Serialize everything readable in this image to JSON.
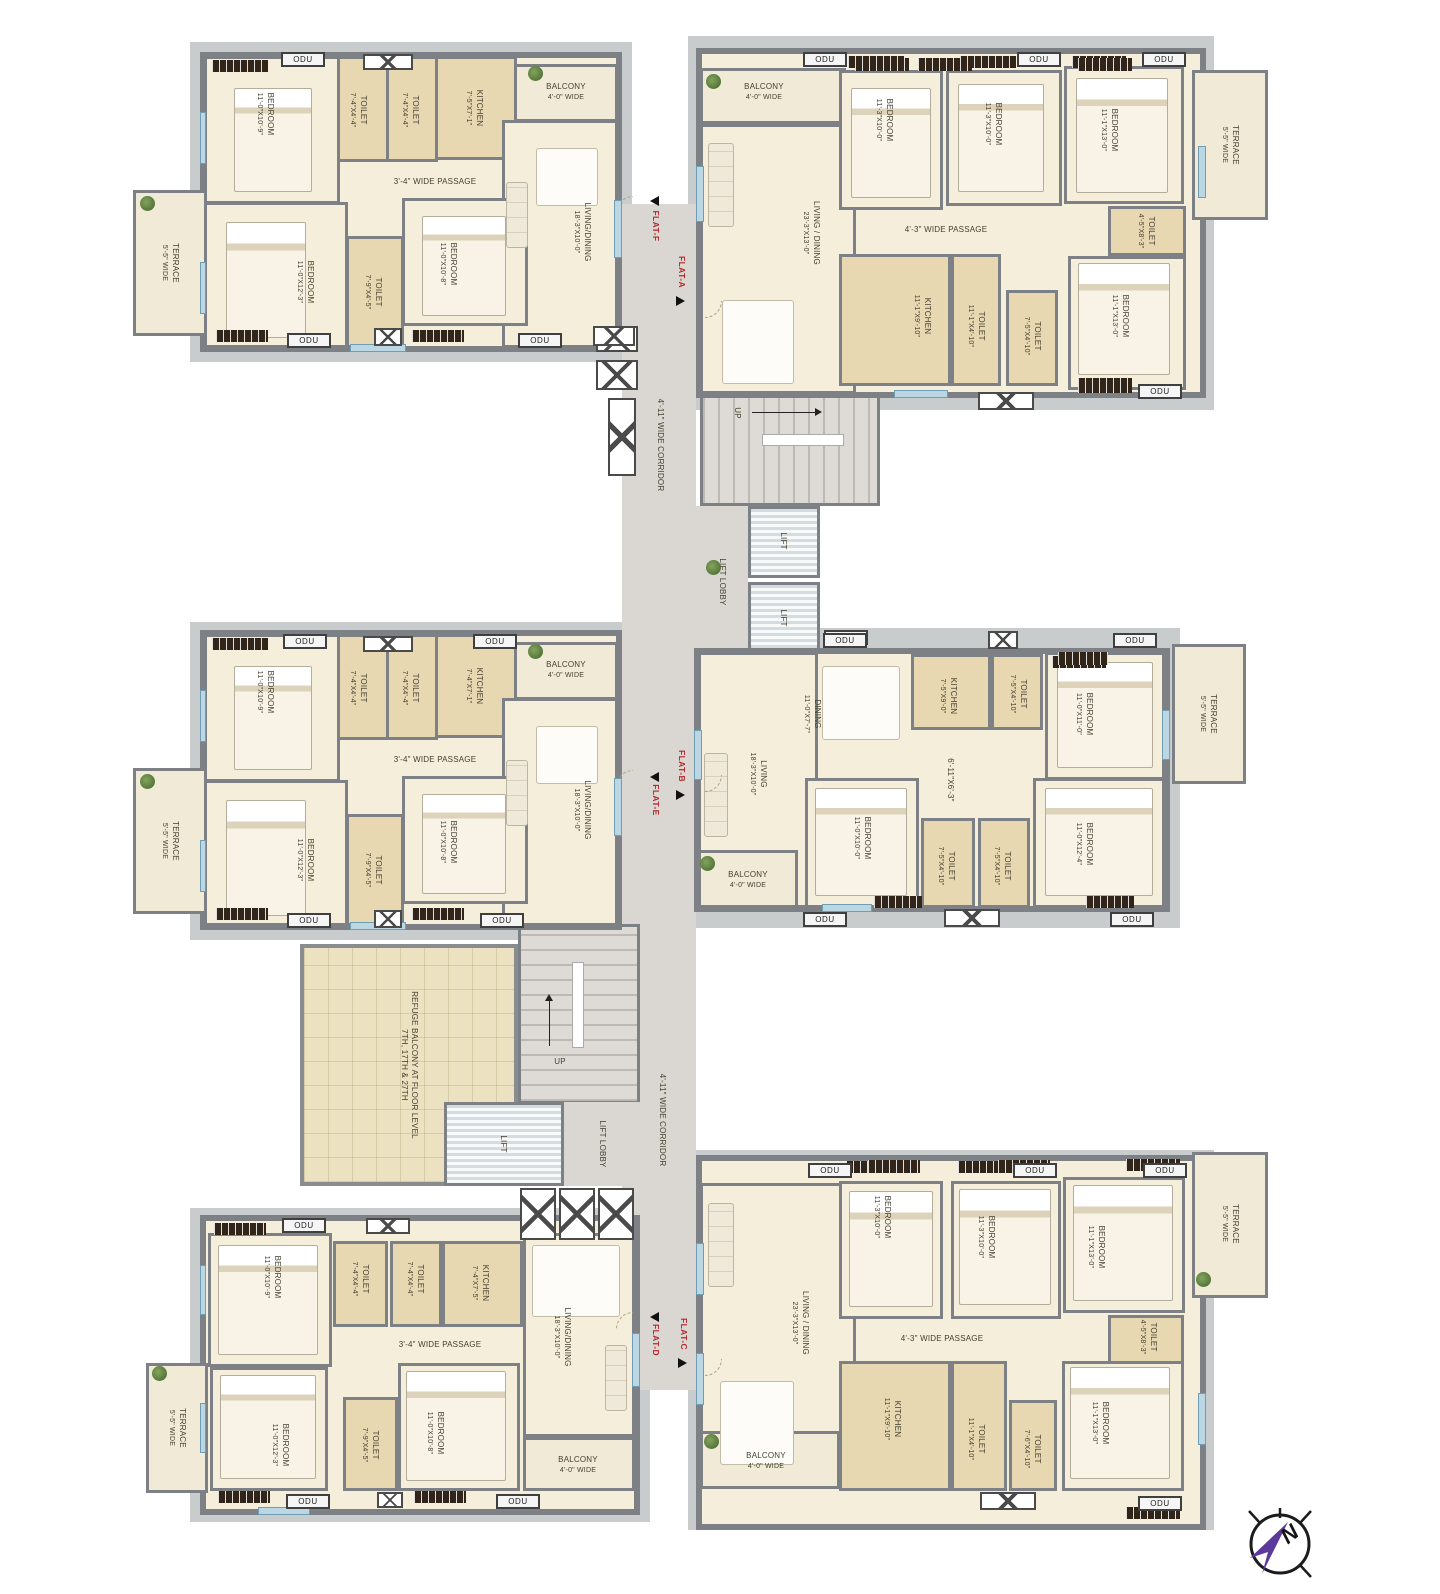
{
  "labels": {
    "odu": "ODU"
  },
  "compass": {
    "n": "N"
  },
  "core_top": {
    "corridor": "4'-11\" WIDE CORRIDOR",
    "lift_lobby": "LIFT LOBBY",
    "lift_a": "LIFT",
    "lift_b": "LIFT",
    "up": "UP"
  },
  "core_bottom": {
    "corridor": "4'-11\" WIDE CORRIDOR",
    "lift_lobby": "LIFT LOBBY",
    "lift": "LIFT",
    "up": "UP",
    "refuge_line1": "REFUGE BALCONY AT FLOOR LEVEL",
    "refuge_line2": "7TH, 17TH & 27TH"
  },
  "flats": {
    "flat_f": {
      "tag": "FLAT-F",
      "rooms": {
        "bedroom1": {
          "name": "BEDROOM",
          "dim": "11'-0\"X10'-9\""
        },
        "toilet1": {
          "name": "TOILET",
          "dim": "7'-4\"X4'-4\""
        },
        "toilet2": {
          "name": "TOILET",
          "dim": "7'-4\"X4'-4\""
        },
        "kitchen": {
          "name": "KITCHEN",
          "dim": "7'-5\"X7'-1\""
        },
        "balcony": {
          "name": "BALCONY",
          "dim": "4'-0\" WIDE"
        },
        "passage": {
          "name": "3'-4\" WIDE PASSAGE"
        },
        "bedroom2": {
          "name": "BEDROOM",
          "dim": "11'-0\"X12'-3\""
        },
        "toilet3": {
          "name": "TOILET",
          "dim": "7'-9\"X4'-5\""
        },
        "bedroom3": {
          "name": "BEDROOM",
          "dim": "11'-0\"X10'-8\""
        },
        "living": {
          "name": "LIVING/DINING",
          "dim": "18'-3\"X10'-0\""
        },
        "terrace": {
          "name": "TERRACE",
          "dim": "5'-5\" WIDE"
        }
      }
    },
    "flat_a": {
      "tag": "FLAT-A",
      "rooms": {
        "balcony": {
          "name": "BALCONY",
          "dim": "4'-0\" WIDE"
        },
        "living": {
          "name": "LIVING / DINING",
          "dim": "23'-3\"X13'-0\""
        },
        "bedroom1": {
          "name": "BEDROOM",
          "dim": "11'-3\"X10'-0\""
        },
        "bedroom2": {
          "name": "BEDROOM",
          "dim": "11'-3\"X10'-0\""
        },
        "bedroom3": {
          "name": "BEDROOM",
          "dim": "11'-1\"X13'-0\""
        },
        "toilet1": {
          "name": "TOILET",
          "dim": "4'-5\"X8'-3\""
        },
        "bedroom4": {
          "name": "BEDROOM",
          "dim": "11'-1\"X13'-0\""
        },
        "passage": {
          "name": "4'-3\" WIDE PASSAGE"
        },
        "kitchen": {
          "name": "KITCHEN",
          "dim": "11'-1\"X9'-10\""
        },
        "toilet2": {
          "name": "TOILET",
          "dim": "11'-1\"X4'-10\""
        },
        "toilet3": {
          "name": "TOILET",
          "dim": "7'-5\"X4'-10\""
        },
        "terrace": {
          "name": "TERRACE",
          "dim": "5'-5\" WIDE"
        }
      }
    },
    "flat_e": {
      "tag": "FLAT-E",
      "rooms": {
        "bedroom1": {
          "name": "BEDROOM",
          "dim": "11'-0\"X10'-9\""
        },
        "toilet1": {
          "name": "TOILET",
          "dim": "7'-4\"X4'-4\""
        },
        "toilet2": {
          "name": "TOILET",
          "dim": "7'-4\"X4'-4\""
        },
        "kitchen": {
          "name": "KITCHEN",
          "dim": "7'-4\"X7'-1\""
        },
        "balcony": {
          "name": "BALCONY",
          "dim": "4'-0\" WIDE"
        },
        "passage": {
          "name": "3'-4\" WIDE PASSAGE"
        },
        "bedroom2": {
          "name": "BEDROOM",
          "dim": "11'-0\"X12'-3\""
        },
        "toilet3": {
          "name": "TOILET",
          "dim": "7'-9\"X4'-5\""
        },
        "bedroom3": {
          "name": "BEDROOM",
          "dim": "11'-0\"X10'-8\""
        },
        "living": {
          "name": "LIVING/DINING",
          "dim": "18'-3\"X10'-0\""
        },
        "terrace": {
          "name": "TERRACE",
          "dim": "5'-5\" WIDE"
        }
      }
    },
    "flat_b": {
      "tag": "FLAT-B",
      "rooms": {
        "living": {
          "name": "LIVING",
          "dim": "18'-3\"X10'-0\""
        },
        "dining": {
          "name": "DINING",
          "dim": "11'-0\"X7'-7\""
        },
        "kitchen": {
          "name": "KITCHEN",
          "dim": "7'-5\"X9'-0\""
        },
        "toilet1": {
          "name": "TOILET",
          "dim": "7'-5\"X4'-10\""
        },
        "bedroom1": {
          "name": "BEDROOM",
          "dim": "11'-0\"X11'-0\""
        },
        "passage": {
          "name": "6'-11\"X6'-3\""
        },
        "bedroom2": {
          "name": "BEDROOM",
          "dim": "11'-0\"X10'-0\""
        },
        "toilet2": {
          "name": "TOILET",
          "dim": "7'-5\"X4'-10\""
        },
        "toilet3": {
          "name": "TOILET",
          "dim": "7'-5\"X4'-10\""
        },
        "bedroom3": {
          "name": "BEDROOM",
          "dim": "11'-0\"X12'-4\""
        },
        "balcony": {
          "name": "BALCONY",
          "dim": "4'-0\" WIDE"
        },
        "terrace": {
          "name": "TERRACE",
          "dim": "5'-5\" WIDE"
        }
      }
    },
    "flat_d": {
      "tag": "FLAT-D",
      "rooms": {
        "bedroom1": {
          "name": "BEDROOM",
          "dim": "11'-0\"X10'-9\""
        },
        "toilet1": {
          "name": "TOILET",
          "dim": "7'-4\"X4'-4\""
        },
        "toilet2": {
          "name": "TOILET",
          "dim": "7'-4\"X4'-4\""
        },
        "kitchen": {
          "name": "KITCHEN",
          "dim": "7'-4\"X7'-5\""
        },
        "living": {
          "name": "LIVING/DINING",
          "dim": "18'-3\"X10'-0\""
        },
        "passage": {
          "name": "3'-4\" WIDE PASSAGE"
        },
        "bedroom2": {
          "name": "BEDROOM",
          "dim": "11'-0\"X12'-3\""
        },
        "toilet3": {
          "name": "TOILET",
          "dim": "7'-9\"X4'-5\""
        },
        "bedroom3": {
          "name": "BEDROOM",
          "dim": "11'-0\"X10'-8\""
        },
        "balcony": {
          "name": "BALCONY",
          "dim": "4'-0\" WIDE"
        },
        "terrace": {
          "name": "TERRACE",
          "dim": "5'-5\" WIDE"
        }
      }
    },
    "flat_c": {
      "tag": "FLAT-C",
      "rooms": {
        "living": {
          "name": "LIVING / DINING",
          "dim": "23'-3\"X13'-0\""
        },
        "bedroom1": {
          "name": "BEDROOM",
          "dim": "11'-3\"X10'-0\""
        },
        "bedroom2": {
          "name": "BEDROOM",
          "dim": "11'-3\"X10'-0\""
        },
        "bedroom3": {
          "name": "BEDROOM",
          "dim": "11'-1\"X13'-0\""
        },
        "toilet1": {
          "name": "TOILET",
          "dim": "4'-5\"X8'-3\""
        },
        "bedroom4": {
          "name": "BEDROOM",
          "dim": "11'-1\"X13'-0\""
        },
        "passage": {
          "name": "4'-3\" WIDE PASSAGE"
        },
        "kitchen": {
          "name": "KITCHEN",
          "dim": "11'-1\"X9'-10\""
        },
        "toilet2": {
          "name": "TOILET",
          "dim": "11'-1\"X4'-10\""
        },
        "toilet3": {
          "name": "TOILET",
          "dim": "7'-6\"X4'-10\""
        },
        "balcony": {
          "name": "BALCONY",
          "dim": "4'-0\" WIDE"
        },
        "terrace": {
          "name": "TERRACE",
          "dim": "5'-5\" WIDE"
        }
      }
    }
  }
}
